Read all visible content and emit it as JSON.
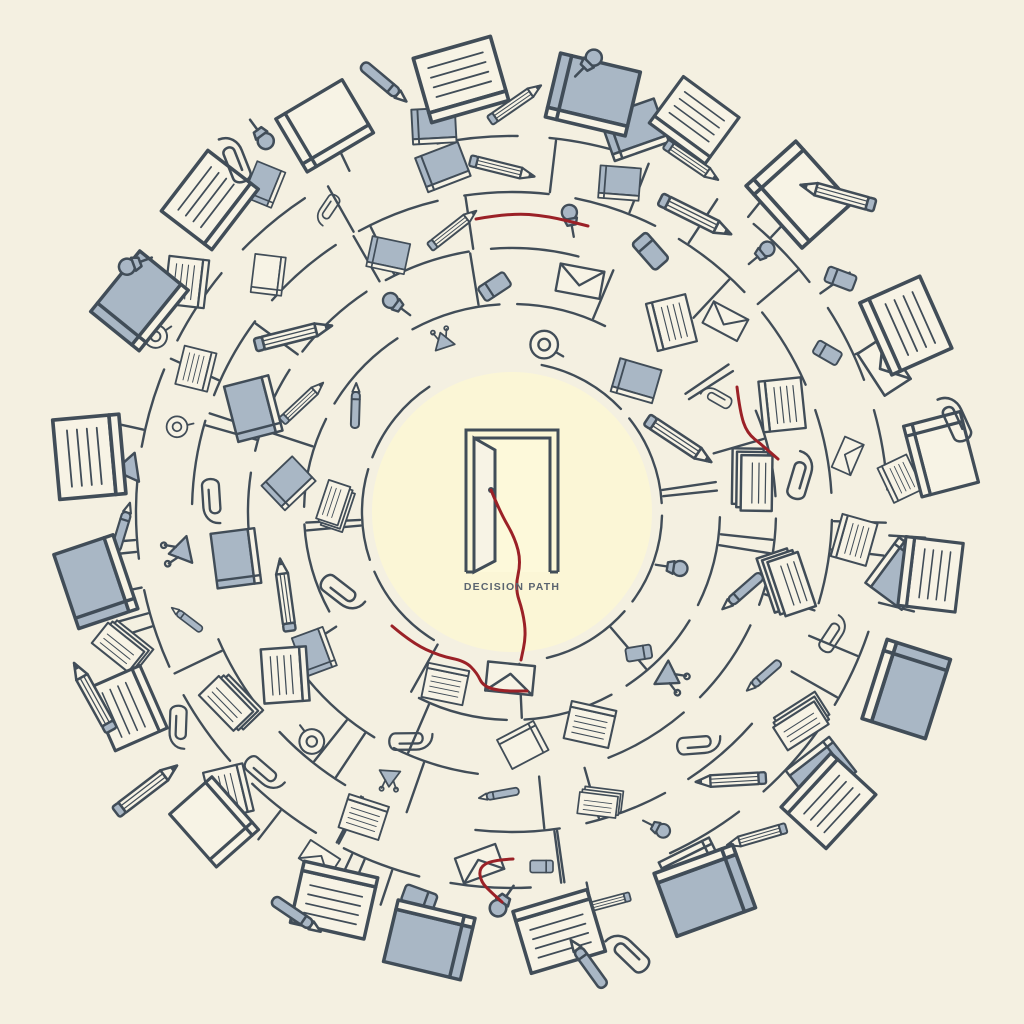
{
  "illustration": {
    "description": "Circular maze assembled from office supplies surrounding an open door at the center; a red thread traces the decision path from the door through the maze",
    "center_label": "DECISION PATH",
    "center_symbol": "open-door-icon",
    "object_icons": [
      "book-icon",
      "notebook-icon",
      "paperclip-icon",
      "pencil-icon",
      "pen-icon",
      "paper-stack-icon",
      "pushpin-icon",
      "eraser-icon",
      "binder-clip-icon",
      "envelope-icon",
      "tape-roll-icon"
    ]
  },
  "palette": {
    "background": "#f4f0e1",
    "paper_fill": "#f7f3e5",
    "object_fill": "#a9b7c5",
    "outline": "#414d58",
    "center_glow": "#fbf6d6",
    "door_glow": "#fdf9da",
    "thread_red": "#9b2127",
    "label_text": "#5a6470"
  },
  "thread": {
    "name": "decision-thread",
    "segments": [
      [
        [
          476,
          219
        ],
        [
          510,
          213
        ],
        [
          548,
          216
        ],
        [
          588,
          226
        ]
      ],
      [
        [
          737,
          387
        ],
        [
          740,
          412
        ],
        [
          747,
          433
        ],
        [
          762,
          445
        ],
        [
          778,
          459
        ]
      ],
      [
        [
          491,
          490
        ],
        [
          500,
          512
        ],
        [
          515,
          538
        ],
        [
          521,
          562
        ],
        [
          515,
          588
        ],
        [
          523,
          612
        ],
        [
          526,
          636
        ],
        [
          521,
          660
        ]
      ],
      [
        [
          392,
          626
        ],
        [
          412,
          643
        ],
        [
          440,
          656
        ],
        [
          465,
          661
        ],
        [
          477,
          673
        ],
        [
          483,
          686
        ],
        [
          500,
          691
        ],
        [
          527,
          691
        ]
      ],
      [
        [
          513,
          859
        ],
        [
          492,
          860
        ],
        [
          479,
          868
        ],
        [
          481,
          882
        ],
        [
          492,
          893
        ],
        [
          502,
          902
        ]
      ]
    ]
  }
}
